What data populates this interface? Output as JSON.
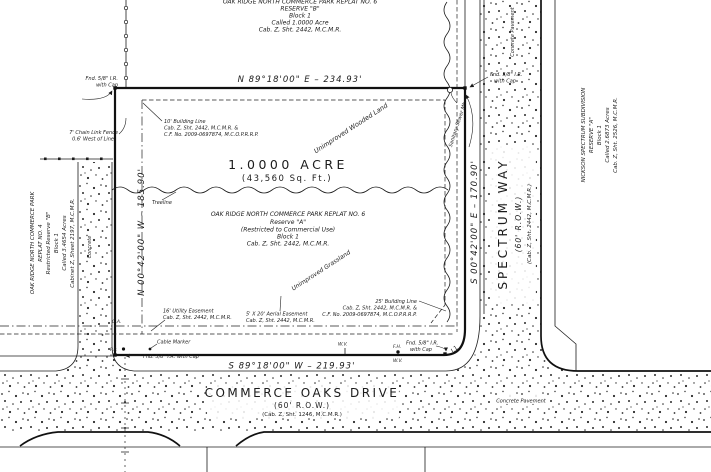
{
  "plat": {
    "north_parcel": {
      "title": "OAK RIDGE NORTH COMMERCE PARK REPLAT NO. 6",
      "reserve": "RESERVE \"B\"",
      "block": "Block 1",
      "called": "Called 1.0000 Acre",
      "record": "Cab. Z, Sht. 2442, M.C.M.R."
    },
    "subject_parcel": {
      "area": "1.0000 ACRE",
      "area_sqft": "(43,560 Sq. Ft.)",
      "title": "OAK RIDGE NORTH COMMERCE PARK REPLAT NO. 6",
      "reserve": "Reserve \"A\"",
      "restriction": "(Restricted to Commercial Use)",
      "block": "Block 1",
      "record": "Cab. Z, Sht. 2442, M.C.M.R."
    },
    "west_parcel": {
      "title": "OAK RIDGE NORTH COMMERCE PARK",
      "replat": "REPLAT NO. 4",
      "reserve": "Restricted Reserve \"B\"",
      "block": "Block 1",
      "called": "Called 3.4654 Acres",
      "record": "Cabinet Z, Sheet 2197, M.C.M.R."
    },
    "east_parcel": {
      "title": "NICKSON SPECTRUM SUBDIVISION",
      "reserve": "RESERVE \"A\"",
      "block": "Block 1",
      "called": "Called 2.6873 Acres",
      "record": "Cab. Z, Sht. 2526, M.C.M.R."
    },
    "bearings": {
      "north": "N 89°18'00\" E  –  234.93'",
      "south": "S 89°18'00\" W  –  219.93'",
      "west": "N 00°42'00\" W  –  185.90'",
      "east": "S 00°42'00\" E  –  170.90'"
    },
    "streets": {
      "commerce_oaks": {
        "name": "COMMERCE OAKS DRIVE",
        "row": "(60' R.O.W.)",
        "record": "(Cab. Z, Sht. 1246, M.C.M.R.)"
      },
      "spectrum_way": {
        "name": "SPECTRUM WAY",
        "row": "(60' R.O.W.)",
        "record": "(Cab. Z, Sht. 2442, M.C.M.R.)"
      }
    },
    "easements": {
      "building_line_10": {
        "l1": "10' Building Line",
        "l2": "Cab. Z, Sht. 2442, M.C.M.R. &",
        "l3": "C.F. No. 2009-0697874, M.C.O.P.R.R.P."
      },
      "building_line_25": {
        "l1": "25' Building Line",
        "l2": "Cab. Z, Sht. 2442, M.C.M.R. &",
        "l3": "C.F. No. 2009-0697874, M.C.O.P.R.R.P."
      },
      "utility_16": {
        "l1": "16' Utility Easement",
        "l2": "Cab. Z, Sht. 2442, M.C.M.R."
      },
      "aerial_5x20": {
        "l1": "5' X 20' Aerial Easement",
        "l2": "Cab. Z, Sht. 2442, M.C.M.R."
      }
    },
    "monuments": {
      "found_ir": "Fnd. 5/8\" I.R.",
      "with_cap": "with Cap",
      "found_ir_with_cap": "Fnd. 5/8\" I.R. with Cap"
    },
    "features": {
      "treeline": "Treeline",
      "wooded": "Unimproved Wooded Land",
      "grassland": "Unimproved Grassland",
      "concrete": "Concrete",
      "concrete_pavement": "Concrete Pavement",
      "sanitary_mh": "Sanitary Sewer Mh",
      "fence_l1": "7' Chain Link Fence",
      "fence_l2": "0.6' West of Line",
      "cable_marker": "Cable Marker",
      "power_pole": "P.P.",
      "guy_anchor": "G.A.",
      "fire_hydrant": "F.H.",
      "water_valve": "W.V.",
      "curve_label": "L1"
    }
  }
}
